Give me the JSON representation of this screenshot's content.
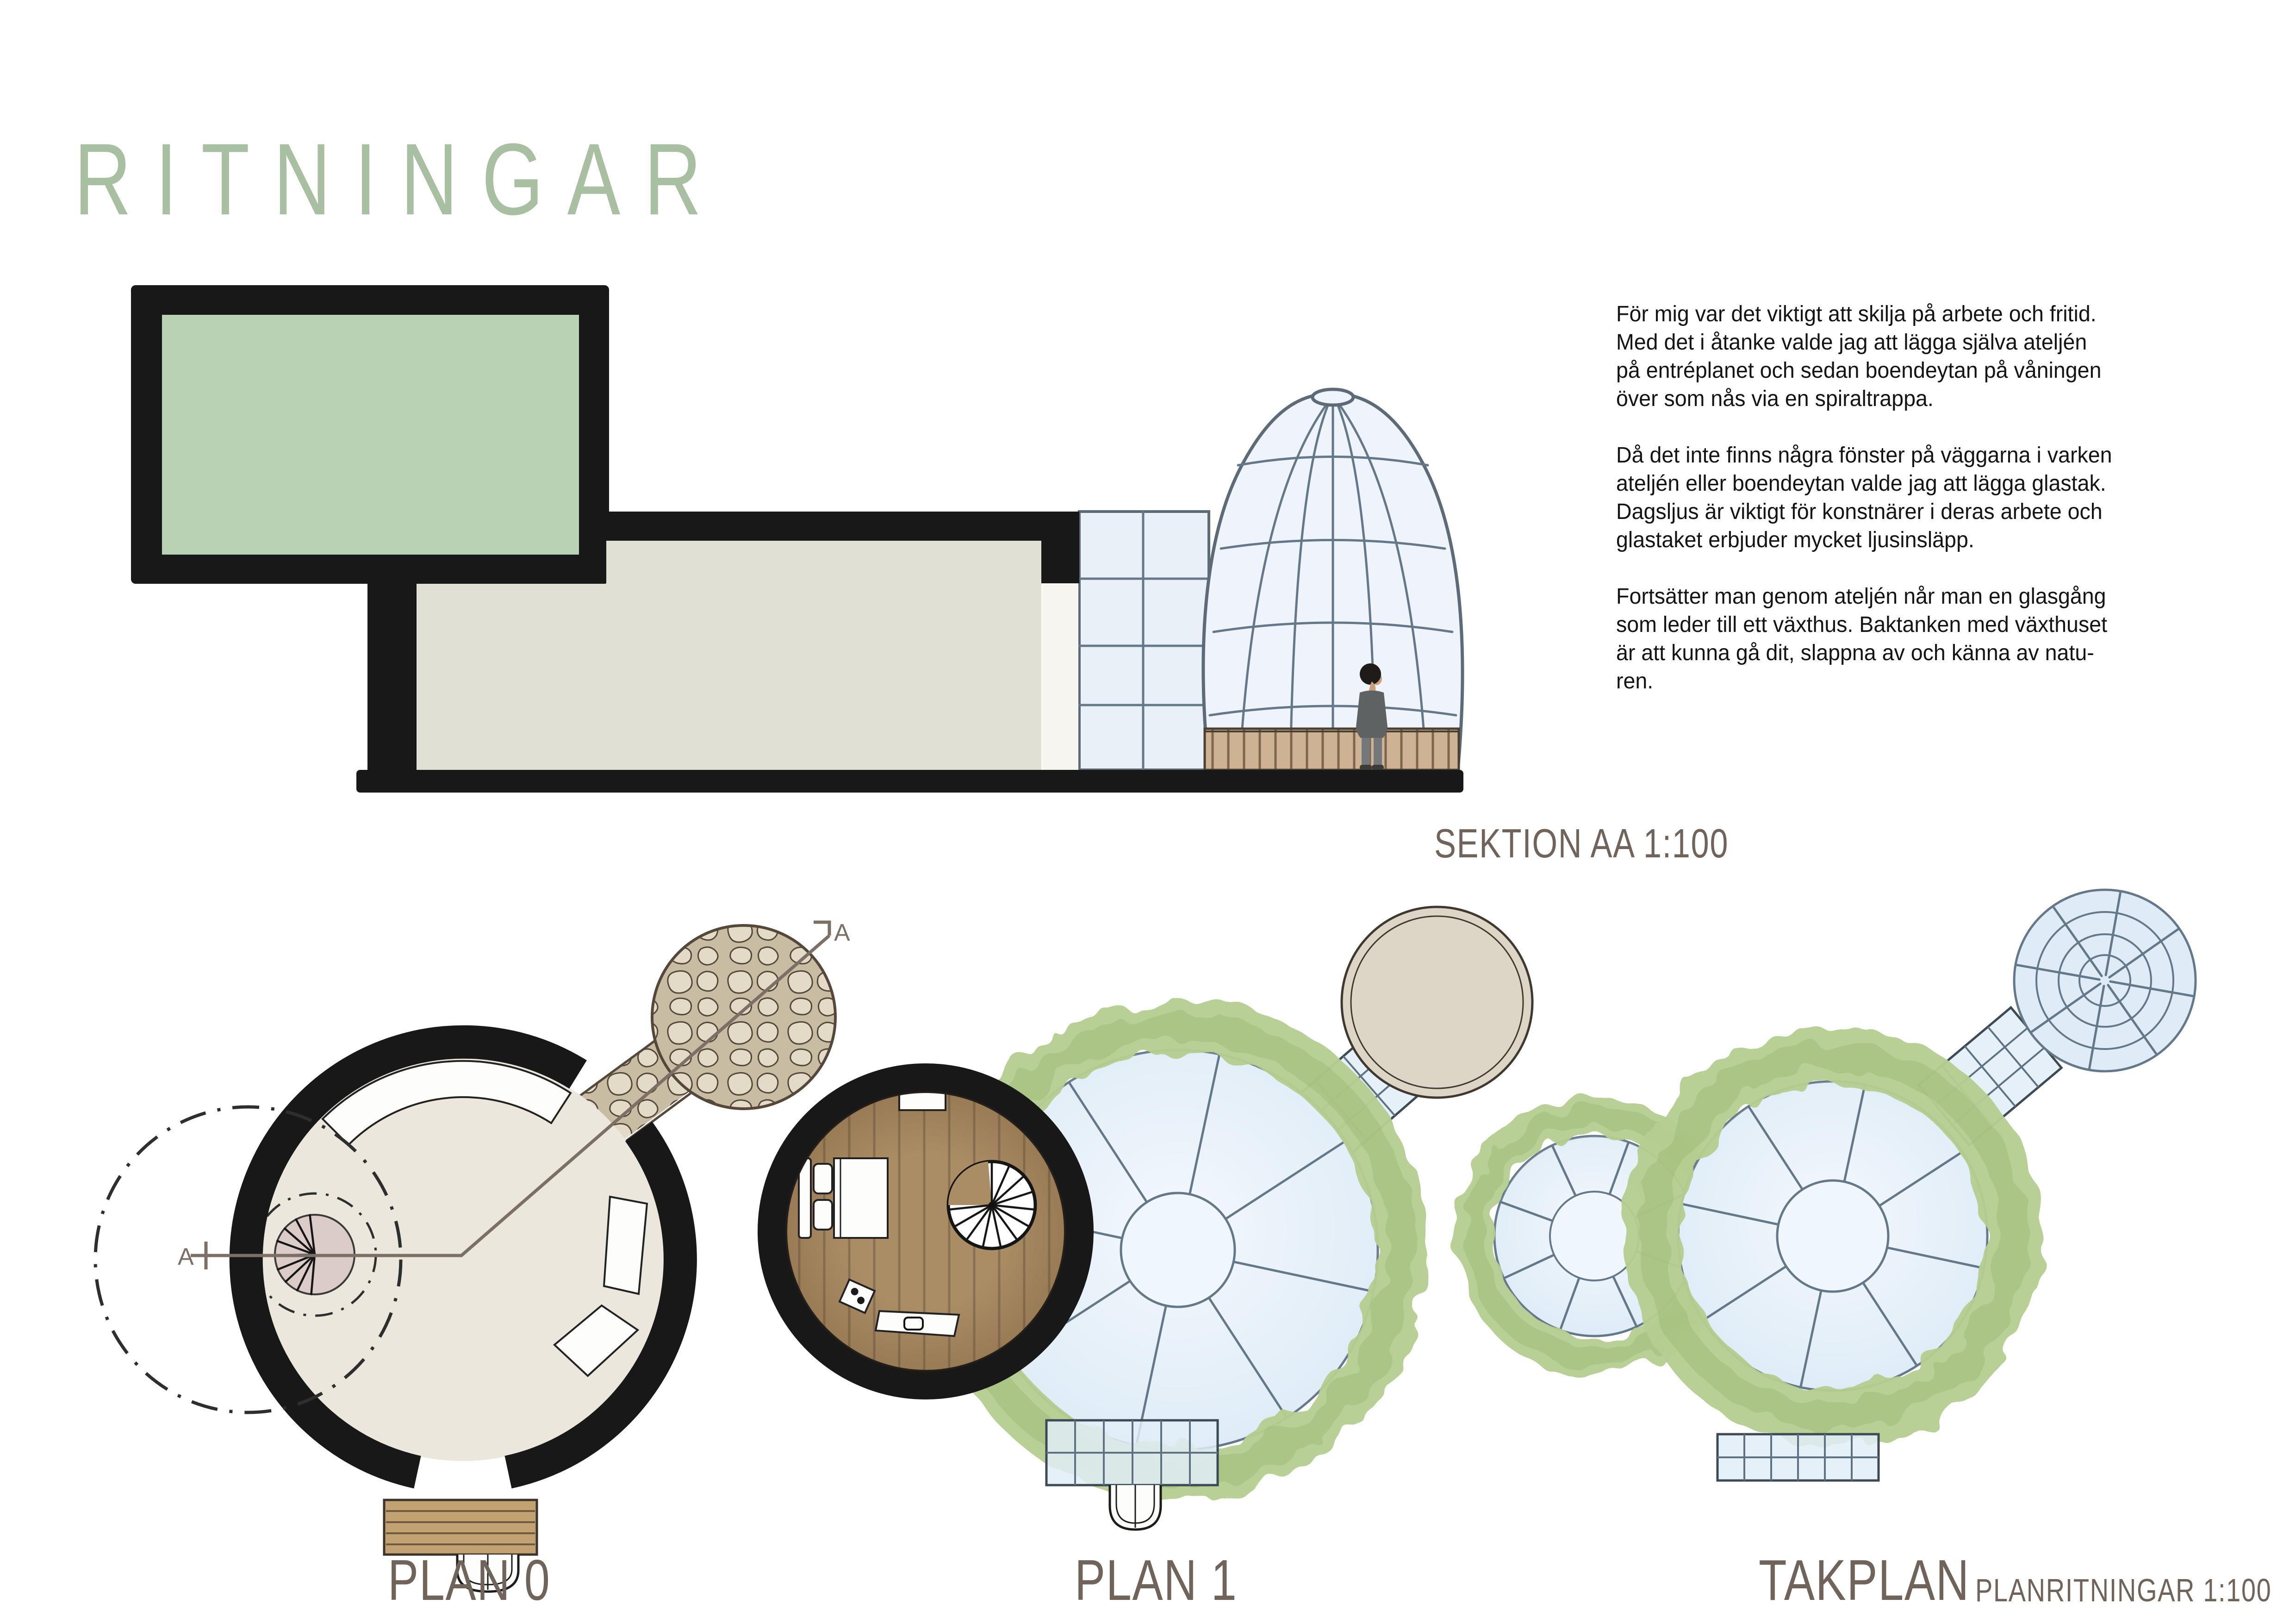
{
  "title": {
    "text": "RITNINGAR"
  },
  "section": {
    "label": "SEKTION AA 1:100",
    "cut_marker": "A"
  },
  "description": {
    "paragraphs": [
      "För mig var det viktigt att skilja på arbete och fritid.\nMed det i åtanke valde jag att lägga själva ateljén\npå entréplanet och sedan boendeytan på våningen\növer som nås via en spiraltrappa.",
      "Då det inte finns några fönster på väggarna i varken\nateljén eller boendeytan valde jag att lägga glastak.\nDagsljus är viktigt för konstnärer i deras arbete och\nglastaket erbjuder mycket ljusinsläpp.",
      "Fortsätter man genom ateljén når man en glasgång\nsom leder till ett växthus. Baktanken med växthuset\när att kunna gå dit, slappna av och känna av natu-\nren."
    ]
  },
  "plans": {
    "plan0_label": "PLAN 0",
    "plan1_label": "PLAN 1",
    "takplan_label": "TAKPLAN",
    "scale_label": "PLANRITNINGAR 1:100"
  },
  "palette": {
    "pageBg": "#ffffff",
    "ink": "#181818",
    "titleGreen": "#a9bfa1",
    "label": "#6f635a",
    "cutLine": "#7b6f66",
    "roomGreen": "#b9d2b3",
    "atelier": "#e1e0d5",
    "glassFill": "#e9f0f8",
    "glassLine": "#64788a",
    "domeFill": "#eef4fa",
    "domeLine": "#5c6b77",
    "woodBase": "#cdb293",
    "woodSlat": "#7d6649",
    "woodEdge": "#4a3f33",
    "plan0Fill": "#ebe7dd",
    "stairPink": "#dbccc8",
    "stoneBg": "#c8bca3",
    "stoneFill": "#e3dac8",
    "stoneLine": "#55483a",
    "stepWood": "#c2a173",
    "stepLine": "#6e5a41",
    "floorWood": "#aa8c65",
    "plankLine": "#8a7053",
    "wreath": "#b6ce91",
    "wreathDark": "#9cb974",
    "planGlass": "#dfecf7",
    "planGlassLine": "#64788a",
    "planGlassCenter": "#eff6fc",
    "ghBeige": "#ddd6c7",
    "ghLine": "#3f382e",
    "canopy": "#e2edf8",
    "person": "#5f6263",
    "personLeg": "#75787a",
    "skin": "#c99f7e"
  }
}
